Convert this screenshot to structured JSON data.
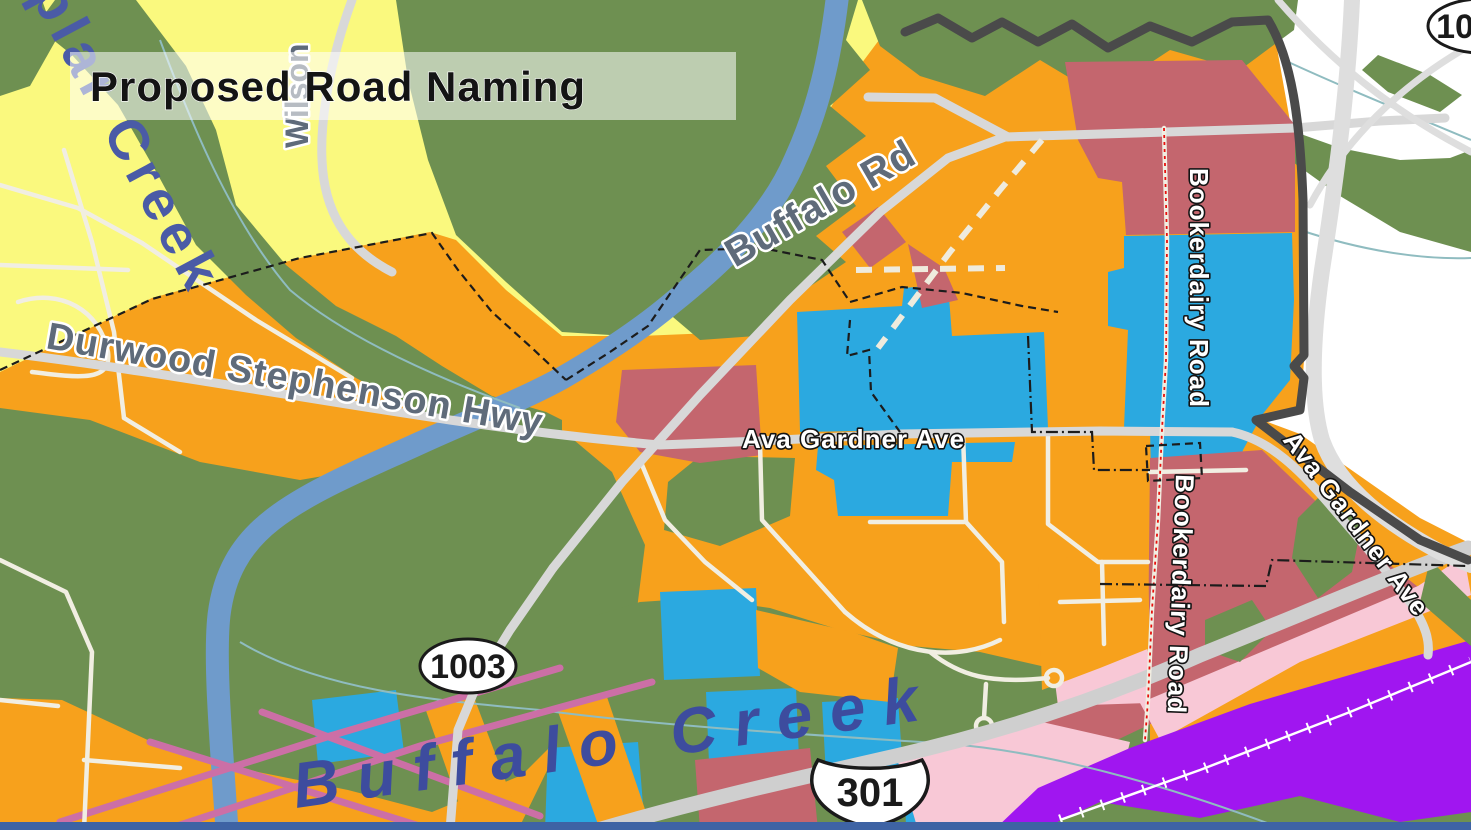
{
  "banner": {
    "title": "Proposed Road Naming"
  },
  "labels": {
    "buffalo_rd": "Buffalo Rd",
    "durwood_hwy": "Durwood Stephenson Hwy",
    "wilson": "Wilson",
    "ava_gardner_center": "Ava Gardner Ave",
    "ava_gardner_right": "Ava Gardner Ave",
    "bookerdairy_top": "Bookerdairy Road",
    "bookerdairy_bottom": "Bookerdairy Road",
    "poplar_creek": "plar Creek",
    "buffalo_creek": "Buffalo Creek"
  },
  "shields": {
    "route_1003": "1003",
    "route_301": "301",
    "route_partial_top_right": "10"
  },
  "colors": {
    "orange_zone": "#F7A11C",
    "yellow_zone": "#FAF97E",
    "green_zone": "#6E9051",
    "blue_zone": "#2BA9E0",
    "maroon_zone": "#C4666E",
    "pink_zone": "#F8C8D6",
    "purple_zone": "#A016F0",
    "river_blue": "#6F9BCB",
    "boundary_gray": "#4A4A4A",
    "proposed_road_highlight_red": "#E8100C",
    "bottom_bar_navy": "#3E63A4"
  }
}
